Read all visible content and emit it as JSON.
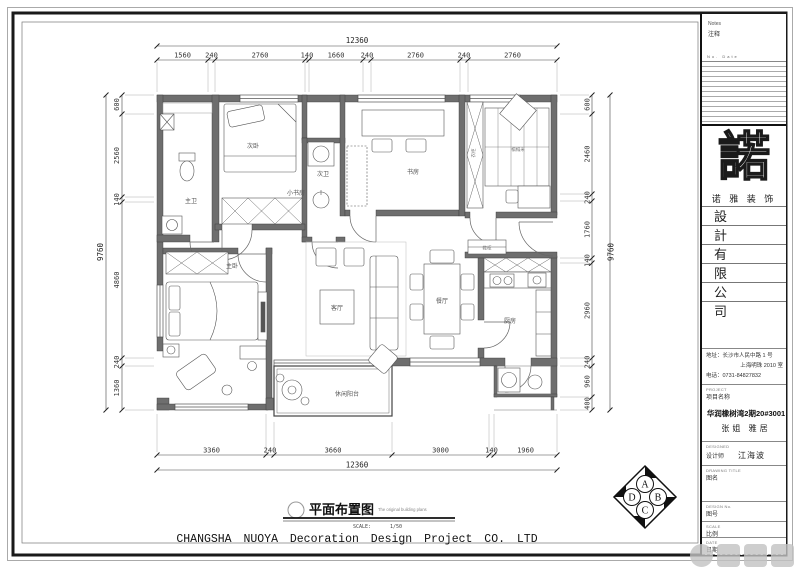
{
  "plan": {
    "dims": {
      "top": {
        "total": "12360",
        "segments": [
          "1560",
          "240",
          "2760",
          "140",
          "1660",
          "240",
          "2760",
          "240",
          "2760"
        ]
      },
      "bottom": {
        "total": "12360",
        "segments": [
          "3360",
          "240",
          "3660",
          "3000",
          "140",
          "1960"
        ]
      },
      "left": {
        "total": "9760",
        "segments": [
          "600",
          "2560",
          "140",
          "4860",
          "240",
          "1360"
        ]
      },
      "right": {
        "total": "9760",
        "segments": [
          "600",
          "2460",
          "240",
          "1760",
          "140",
          "2960",
          "240",
          "960",
          "400"
        ]
      }
    },
    "rooms": {
      "master_bath": "主卫",
      "bedroom2": "次卧",
      "bath2": "次卫",
      "study": "书房",
      "small_study": "小书房",
      "wardrobe": "衣柜",
      "tatami": "榻榻米",
      "shoe_cabinet": "鞋柜",
      "master_bedroom": "主卧",
      "living": "客厅",
      "dining": "餐厅",
      "kitchen": "厨房",
      "leisure_balcony": "休闲阳台"
    }
  },
  "title_block": {
    "title_cn": "平面布置图",
    "title_en": "The original building plans",
    "scale_label": "SCALE:",
    "scale_value": "1/50",
    "company_en": "CHANGSHA NUOYA Decoration Design Project CO. LTD"
  },
  "compass": {
    "a": "A",
    "b": "B",
    "c": "C",
    "d": "D"
  },
  "sidebar": {
    "notes_en": "Notes",
    "notes_cn": "注释",
    "rev_header": "No.  Date",
    "logo_char": "諾",
    "brand": "诺 雅 装 饰",
    "company_chars": [
      "設",
      "計",
      "有",
      "限",
      "公",
      "司"
    ],
    "address_line1": "地址：长沙市人民中路 1 号",
    "address_line2": "上海明珠 2010 室",
    "address_line3": "电话：0731-84827832",
    "project_en": "PROJECT",
    "project_cn": "项目名称",
    "project_name": "华润橡树湾2期20#3001",
    "project_client": "张姐 雅居",
    "designed_en": "DESIGNED",
    "designed_cn": "设计师",
    "designer": "江海波",
    "drawing_title_en": "DRAWING TITLE",
    "drawing_title_cn": "图名",
    "design_no_en": "DESIGN No.",
    "design_no_cn": "图号",
    "scale_en": "SCALE",
    "scale_cn": "比例",
    "date_en": "DATE",
    "date_cn": "日期"
  }
}
